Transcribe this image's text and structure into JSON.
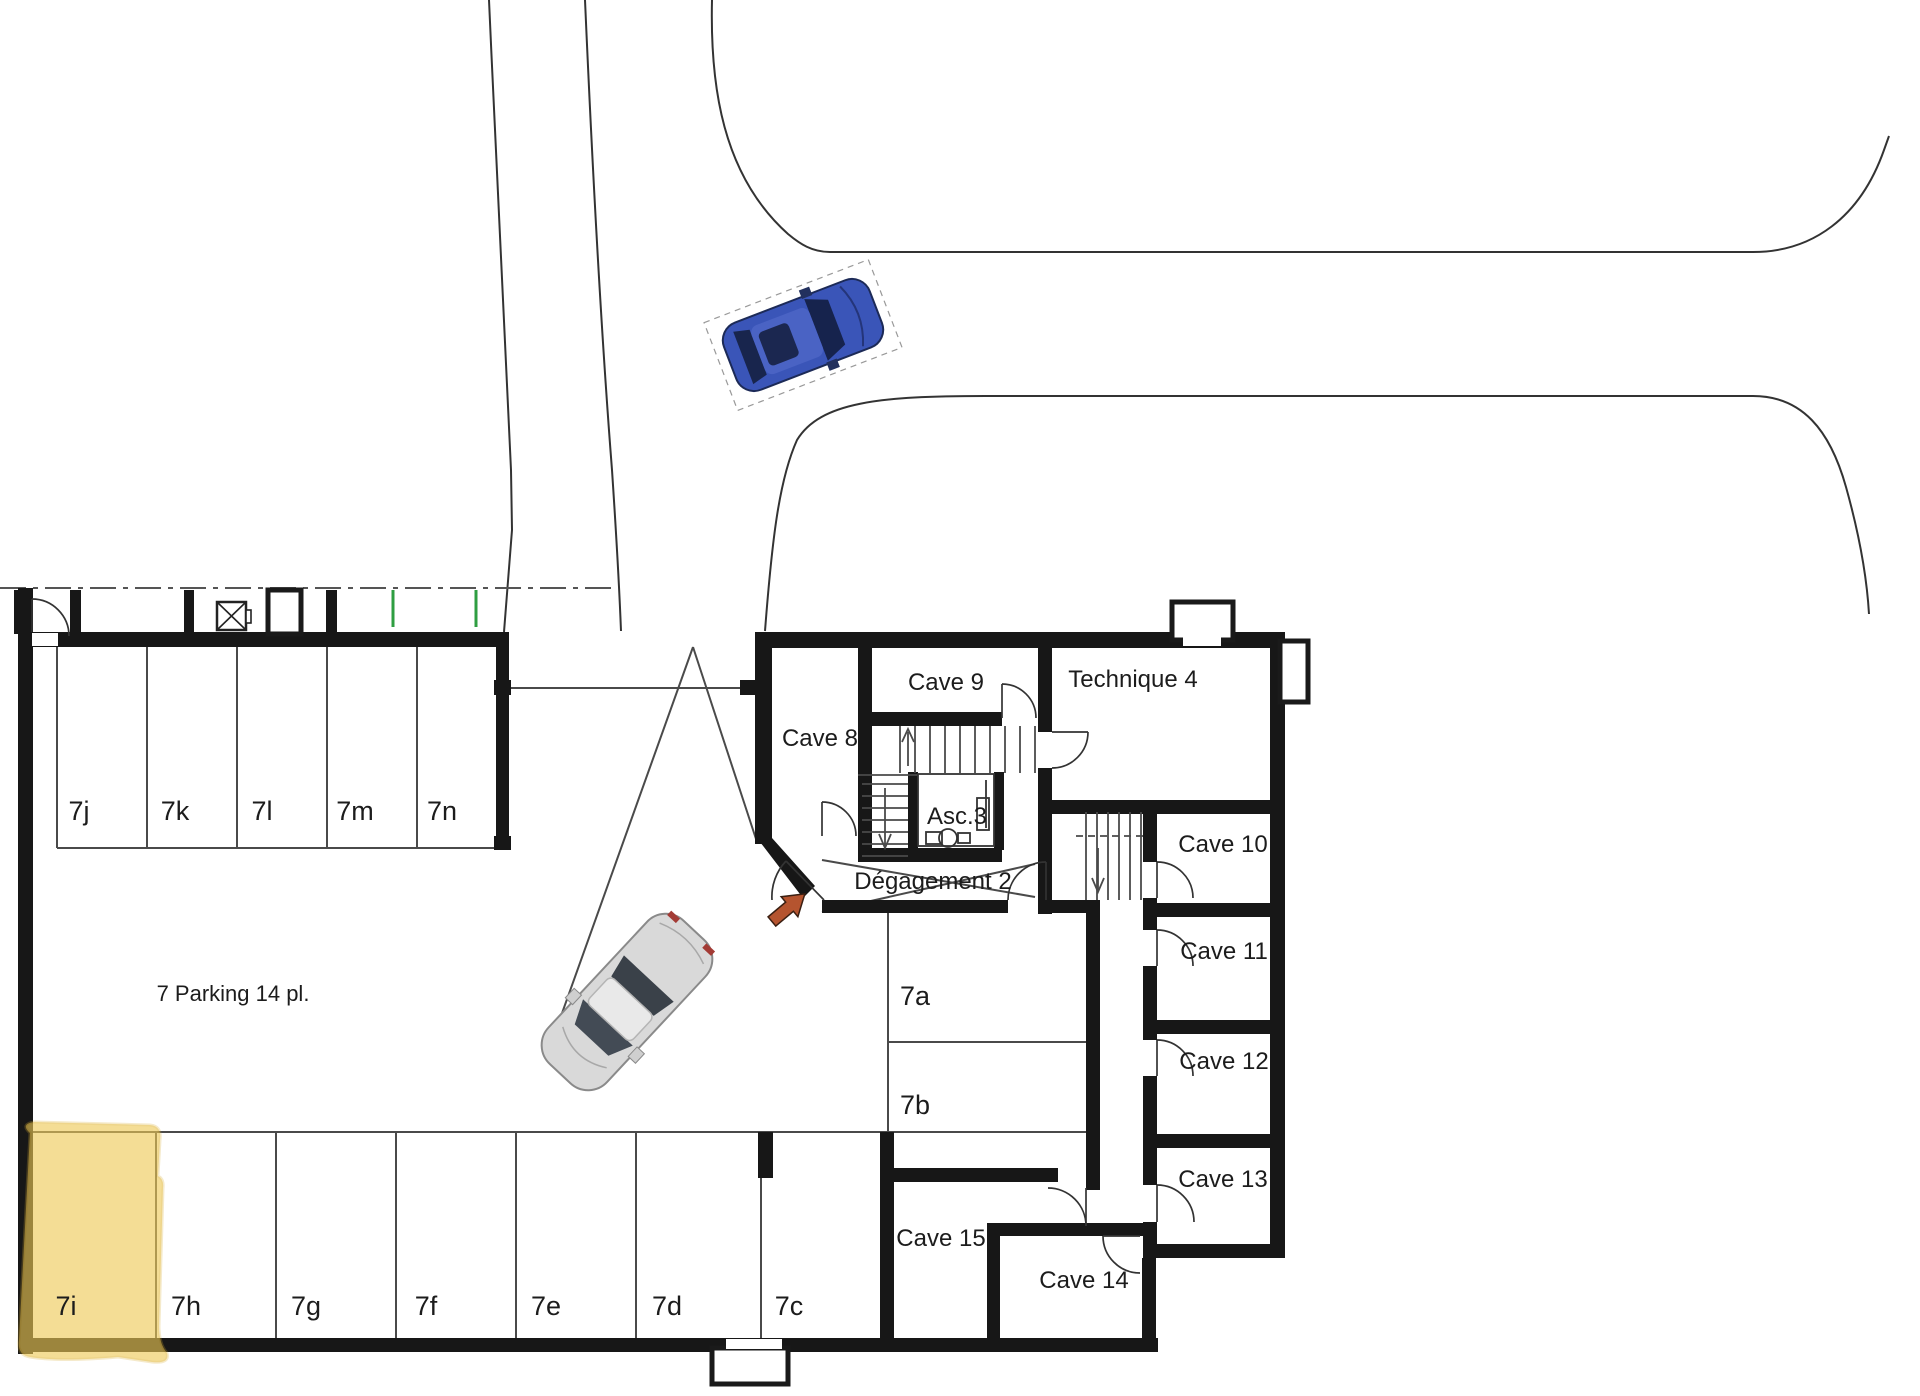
{
  "plan": {
    "title": "7 Parking 14 pl.",
    "highlighted_spot": "7i",
    "spots": {
      "s7a": "7a",
      "s7b": "7b",
      "s7c": "7c",
      "s7d": "7d",
      "s7e": "7e",
      "s7f": "7f",
      "s7g": "7g",
      "s7h": "7h",
      "s7i": "7i",
      "s7j": "7j",
      "s7k": "7k",
      "s7l": "7l",
      "s7m": "7m",
      "s7n": "7n"
    },
    "rooms": {
      "cave8": "Cave 8",
      "cave9": "Cave 9",
      "cave10": "Cave 10",
      "cave11": "Cave 11",
      "cave12": "Cave 12",
      "cave13": "Cave 13",
      "cave14": "Cave 14",
      "cave15": "Cave 15",
      "technique": "Technique 4",
      "elevator": "Asc.3",
      "hallway": "Dégagement 2"
    },
    "colors": {
      "highlight": "#eec955",
      "wall": "#171717",
      "thin_line": "#4a4a4a",
      "green_mark": "#2f9e41",
      "entry_arrow": "#b5542f",
      "car_blue": "#3a55b8",
      "car_blue_glass": "#16234d",
      "car_silver": "#d9d9d9",
      "car_silver_glass": "#434b55"
    }
  }
}
